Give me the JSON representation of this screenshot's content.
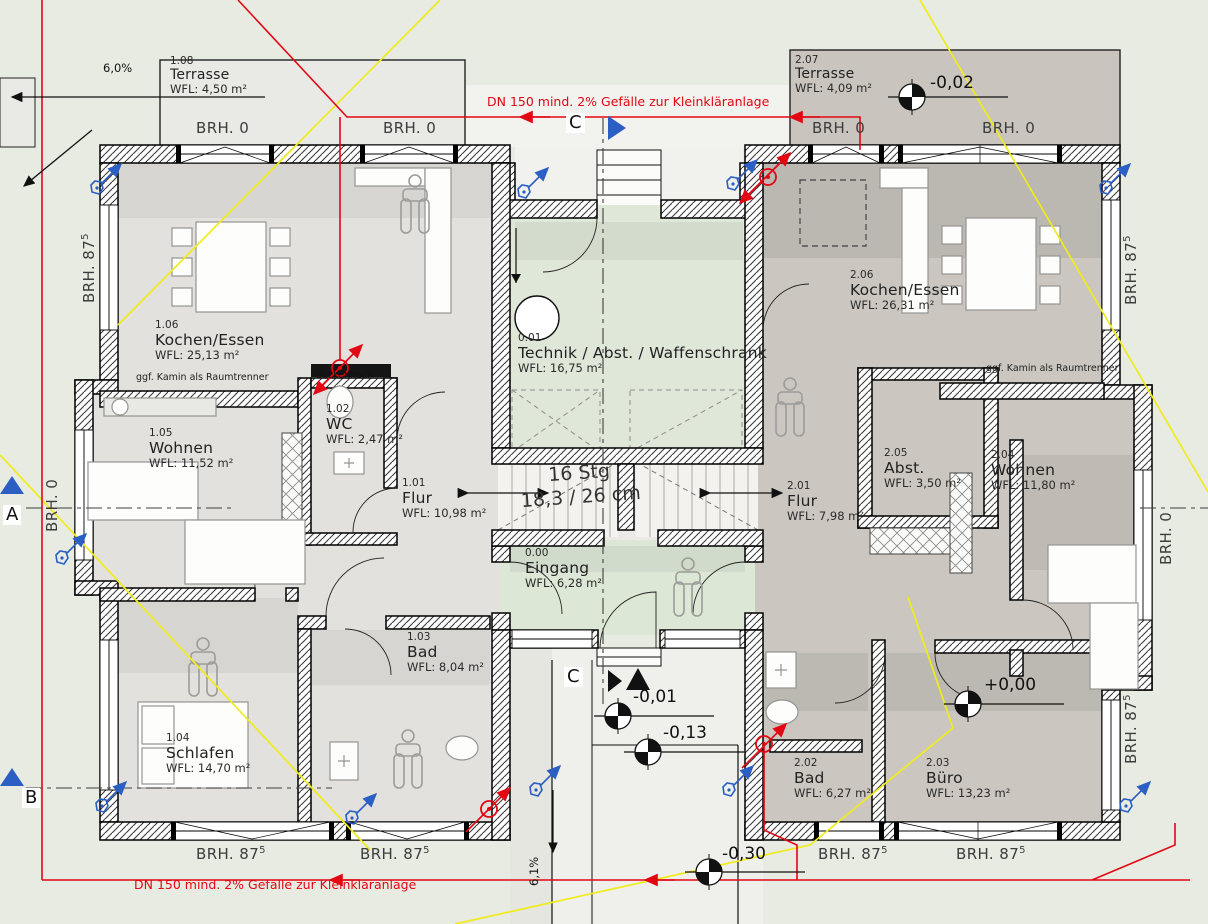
{
  "plan_type": "floor-plan",
  "rooms": {
    "r108": {
      "id": "1.08",
      "name": "Terrasse",
      "area": "WFL: 4,50 m²"
    },
    "r207": {
      "id": "2.07",
      "name": "Terrasse",
      "area": "WFL: 4,09 m²"
    },
    "r106": {
      "id": "1.06",
      "name": "Kochen/Essen",
      "area": "WFL: 25,13 m²"
    },
    "r105": {
      "id": "1.05",
      "name": "Wohnen",
      "area": "WFL: 11,52 m²"
    },
    "r102": {
      "id": "1.02",
      "name": "WC",
      "area": "WFL: 2,47 m²"
    },
    "r101": {
      "id": "1.01",
      "name": "Flur",
      "area": "WFL: 10,98 m²"
    },
    "r001": {
      "id": "0.01",
      "name": "Technik / Abst. / Waffenschrank",
      "area": "WFL: 16,75 m²"
    },
    "r000": {
      "id": "0.00",
      "name": "Eingang",
      "area": "WFL: 6,28 m²"
    },
    "r103": {
      "id": "1.03",
      "name": "Bad",
      "area": "WFL: 8,04 m²"
    },
    "r104": {
      "id": "1.04",
      "name": "Schlafen",
      "area": "WFL: 14,70 m²"
    },
    "r206": {
      "id": "2.06",
      "name": "Kochen/Essen",
      "area": "WFL: 26,31 m²"
    },
    "r205": {
      "id": "2.05",
      "name": "Abst.",
      "area": "WFL: 3,50 m²"
    },
    "r204": {
      "id": "2.04",
      "name": "Wohnen",
      "area": "WFL: 11,80 m²"
    },
    "r201": {
      "id": "2.01",
      "name": "Flur",
      "area": "WFL: 7,98 m²"
    },
    "r202": {
      "id": "2.02",
      "name": "Bad",
      "area": "WFL: 6,27 m²"
    },
    "r203": {
      "id": "2.03",
      "name": "Büro",
      "area": "WFL: 13,23 m²"
    }
  },
  "levels": {
    "terrace_right": "-0,02",
    "entry_court_upper": "-0,01",
    "entry_court_lower": "-0,13",
    "buero": "+0,00",
    "driveway": "-0,30"
  },
  "notes": {
    "sewage": "DN 150 mind. 2% Gefälle zur Kleinkläranlage",
    "kamin": "ggf. Kamin als Raumtrenner",
    "deckenhoch": "deckenhoch"
  },
  "slopes": {
    "top_left": "6,0%",
    "driveway": "6,1%"
  },
  "stairs": {
    "count": "16 Stg",
    "dims": "18,3 / 26 cm"
  },
  "brh": {
    "zero": "BRH. 0",
    "b875": "BRH. 87",
    "b875_sup": "5"
  },
  "section_markers": {
    "a": "A",
    "b": "B",
    "c": "C"
  },
  "colors": {
    "site": "#e8ebe2",
    "unit_left": "#e2e1dd",
    "unit_right": "#cbc7c0",
    "green_room": "#dfe7d8",
    "terrace_right": "#c9c5be",
    "terrace_left": "#e9e9e6",
    "pipe_red": "#e30613",
    "boundary_yellow": "#f0ec1a",
    "marker_blue": "#2b5fc4"
  }
}
